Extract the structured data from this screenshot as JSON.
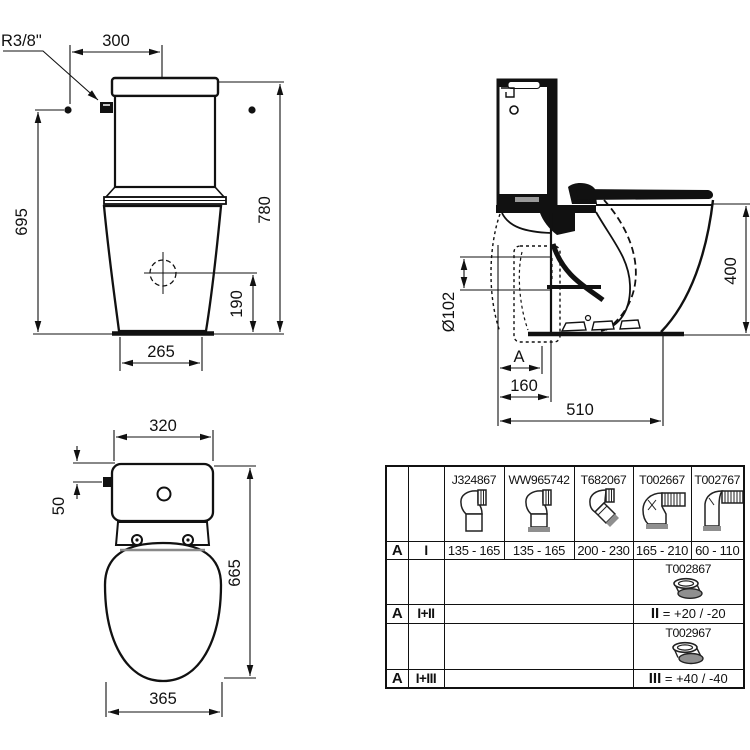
{
  "front_view": {
    "radius_label": "R3/8\"",
    "width_top": "300",
    "height_left": "695",
    "height_total": "780",
    "outlet_height": "190",
    "base_width": "265"
  },
  "side_view": {
    "seat_height": "400",
    "outlet_diameter": "Ø102",
    "rough_in_label": "A",
    "outlet_distance": "160",
    "depth": "510"
  },
  "top_view": {
    "cistern_width": "320",
    "valve_offset": "50",
    "length": "665",
    "bowl_width": "365"
  },
  "table": {
    "products": [
      {
        "code": "J324867",
        "range": "135 - 165"
      },
      {
        "code": "WW965742",
        "range": "135 - 165"
      },
      {
        "code": "T682067",
        "range": "200 - 230"
      },
      {
        "code": "T002667",
        "range": "165 - 210"
      },
      {
        "code": "T002767",
        "range": "60 - 110"
      }
    ],
    "rows": {
      "row1": {
        "a": "A",
        "set": "I"
      },
      "row2": {
        "code": "T002867"
      },
      "row3": {
        "a": "A",
        "set": "I+II",
        "note_label": "II",
        "note_value": "= +20 / -20"
      },
      "row4": {
        "code": "T002967"
      },
      "row5": {
        "a": "A",
        "set": "I+III",
        "note_label": "III",
        "note_value": "= +40 / -40"
      }
    }
  },
  "colors": {
    "line": "#111111",
    "gasket_gray": "#8f8f8f",
    "slot_gray": "#999999"
  }
}
